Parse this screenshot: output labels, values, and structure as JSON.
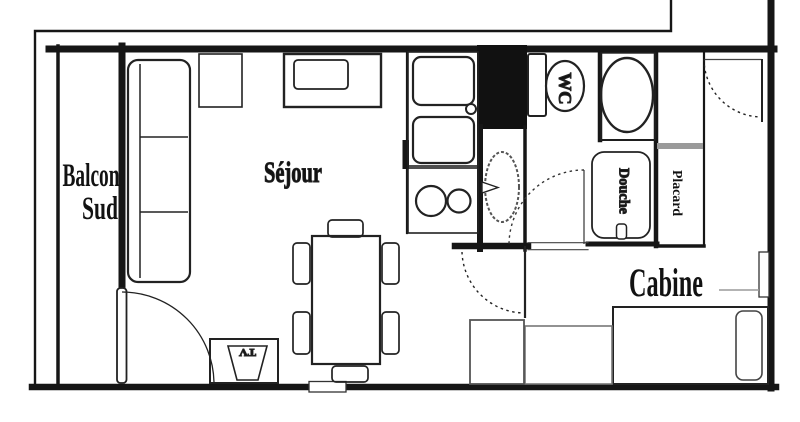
{
  "labels": {
    "balcony_line1": "Balcon",
    "balcony_line2": "Sud",
    "living_room": "Séjour",
    "cabin": "Cabine",
    "wc": "WC",
    "shower": "Douche",
    "closet": "Placard",
    "tv": "TV"
  },
  "colors": {
    "wall": "#161616",
    "technical_duct": "#111111",
    "light_gray_fitting": "#9a9a9a",
    "background": "#ffffff"
  }
}
